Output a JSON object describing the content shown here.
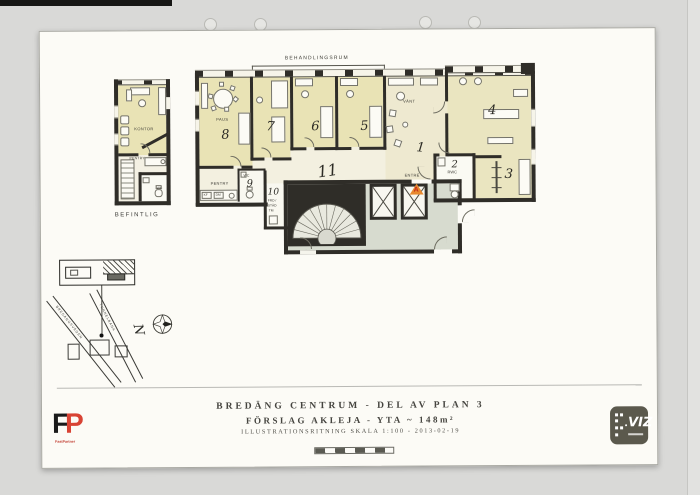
{
  "colors": {
    "scanner_bg": "#d9d9d7",
    "paper": "#fcfbf6",
    "wall": "#2f2d28",
    "room_yellow": "#e9e3b5",
    "room_cream": "#eee9d0",
    "hall_gray": "#d7dbcf",
    "marker_orange": "#e8892f",
    "marker_red": "#c1271b",
    "fastpartner_red": "#d84334",
    "viz_badge_gray": "#5b594d"
  },
  "labels": {
    "behandlingsrum": "BEHANDLINGSRUM",
    "paus": "PAUS",
    "n8": "8",
    "n7": "7",
    "n6": "6",
    "n5": "5",
    "n4": "4",
    "n3": "3",
    "n2": "2",
    "n1": "1",
    "rwc": "RWC",
    "wc": "WC",
    "n9": "9",
    "n10": "10",
    "frd": "FRD /",
    "stad": "STÄD",
    "tm": "TM",
    "n11": "11",
    "vant": "VÄNT",
    "entre": "ENTRÉ",
    "entrance_a": "A",
    "pentry": "PENTRY",
    "kf": "KF",
    "dm": "DM"
  },
  "small_plan": {
    "kontor": "KONTOR",
    "pentry": "PENTRY",
    "wc": "WC",
    "caption": "BEFINTLIG"
  },
  "site_map": {
    "street_left": "BREDÄNGSVÄGEN",
    "street_right": "TUNNELBANA",
    "north": "N"
  },
  "title": {
    "line1": "BREDÄNG CENTRUM - DEL AV PLAN 3",
    "line2": "FÖRSLAG AKLEJA - YTA ~ 148m²",
    "line3": "ILLUSTRATIONSRITNING SKALA 1:100 - 2013-02-19"
  },
  "logos": {
    "f": "F",
    "p": "P",
    "fastpartner": "FastPartner",
    "viz": "VIZ"
  }
}
